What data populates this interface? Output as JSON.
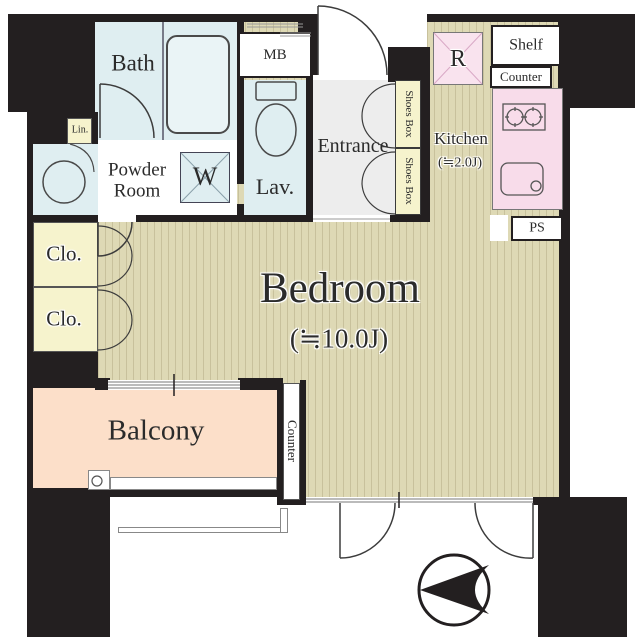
{
  "plan_type": "apartment-floor-plan",
  "colors": {
    "wall": "#231f20",
    "water_rooms": "#dfeef1",
    "storage": "#f6f3cd",
    "kitchen_pink": "#f8dcea",
    "flooring": "#ded9b5",
    "balcony": "#fcdfc9",
    "entrance_floor": "#ededed"
  },
  "rooms": {
    "bath": {
      "label": "Bath"
    },
    "powder_room": {
      "line1": "Powder",
      "line2": "Room"
    },
    "lavatory": {
      "label": "Lav."
    },
    "meter_box": {
      "label": "MB"
    },
    "linen": {
      "label": "Lin."
    },
    "washer": {
      "label": "W"
    },
    "entrance": {
      "label": "Entrance"
    },
    "shoes_box_1": {
      "label": "Shoes Box"
    },
    "shoes_box_2": {
      "label": "Shoes Box"
    },
    "kitchen": {
      "label": "Kitchen",
      "size": "(≒2.0J)"
    },
    "refrigerator": {
      "label": "R"
    },
    "shelf": {
      "label": "Shelf"
    },
    "kitchen_counter": {
      "label": "Counter"
    },
    "pipe_space": {
      "label": "PS"
    },
    "closet_1": {
      "label": "Clo."
    },
    "closet_2": {
      "label": "Clo."
    },
    "bedroom": {
      "label": "Bedroom",
      "size": "(≒10.0J)"
    },
    "balcony": {
      "label": "Balcony"
    },
    "counter_side": {
      "label": "Counter"
    }
  },
  "compass": {
    "icon": "north-arrow-icon",
    "points": "left"
  }
}
